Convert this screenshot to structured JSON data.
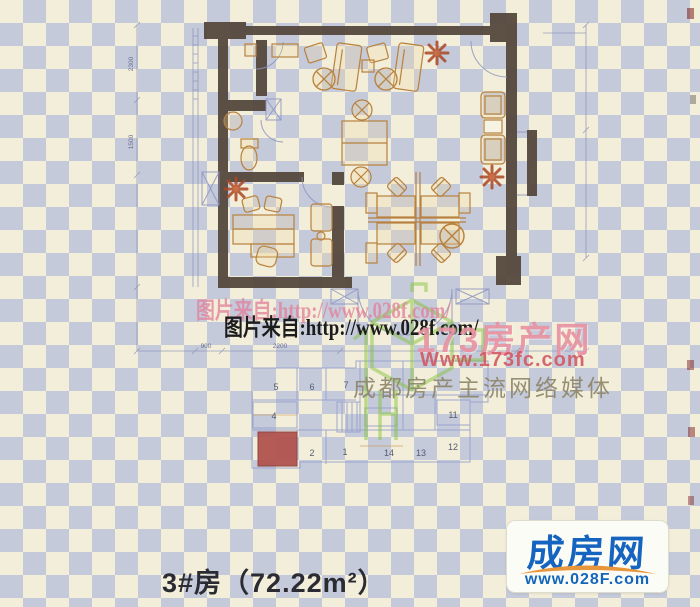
{
  "watermarks": {
    "source_text": "图片来自:http://www.028f.com/",
    "logo_173": {
      "site_name": "173房产网",
      "site_url": "Www.173fc.com",
      "tagline": "成都房产主流网络媒体"
    }
  },
  "floor_plan": {
    "dim_left": [
      {
        "label": "2300"
      },
      {
        "label": "1500"
      }
    ],
    "dim_bottom": [
      {
        "label": "900"
      },
      {
        "label": "2200"
      }
    ]
  },
  "key_plan": {
    "units": [
      {
        "label": "5"
      },
      {
        "label": "6"
      },
      {
        "label": "7"
      },
      {
        "label": "4"
      },
      {
        "label": "11"
      },
      {
        "label": "2"
      },
      {
        "label": "1"
      },
      {
        "label": "14"
      },
      {
        "label": "13"
      },
      {
        "label": "12"
      }
    ]
  },
  "caption": {
    "unit_title": "3#房（72.22m²）"
  },
  "brand": {
    "name": "成房网",
    "url": "www.028F.com"
  },
  "colors": {
    "paper_cream": "#f2eeda",
    "paper_blue": "#a6b2da",
    "wall_dark": "#52453a",
    "furniture_tan": "#b8813e",
    "plant_orange": "#ab4724",
    "keyplan_line": "#9aa2cd",
    "highlight_red": "#b2544e",
    "watermark_pink": "#e1829b",
    "logo_green": "#86c33e",
    "brand_blue": "#1565c0",
    "brand_orange": "#e8963c"
  }
}
